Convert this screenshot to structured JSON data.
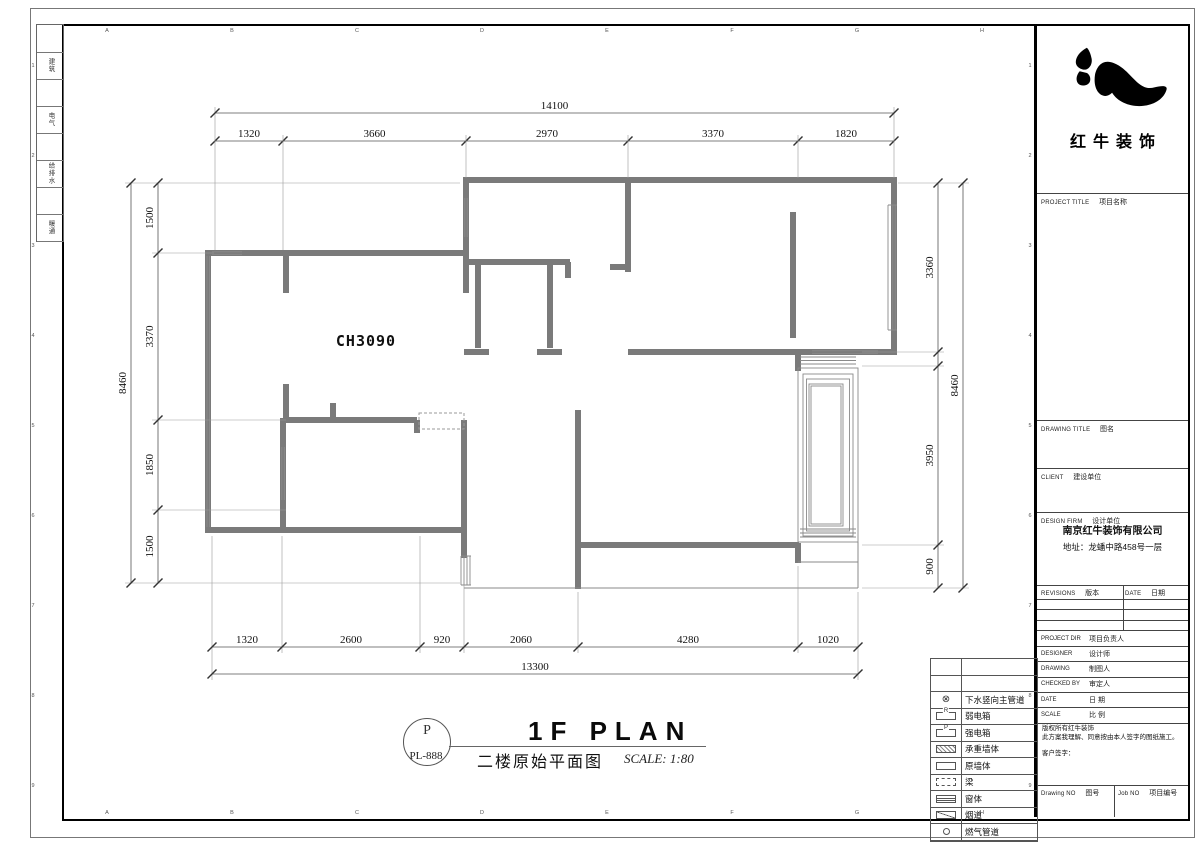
{
  "logo": {
    "company": "红牛装饰"
  },
  "sheet": {
    "disciplines": [
      "建筑",
      "电气",
      "给排水",
      "暖通"
    ],
    "grid_letters": [
      "A",
      "B",
      "C",
      "D",
      "E",
      "F",
      "G",
      "H"
    ],
    "grid_numbers": [
      "1",
      "2",
      "3",
      "4",
      "5",
      "6",
      "7",
      "8",
      "9"
    ]
  },
  "title_block": {
    "project_title": {
      "en": "PROJECT TITLE",
      "cn": "项目名称"
    },
    "drawing_title": {
      "en": "DRAWING TITLE",
      "cn": "图名"
    },
    "client": {
      "en": "CLIENT",
      "cn": "建设单位"
    },
    "design_firm": {
      "en": "DESIGN FIRM",
      "cn": "设计单位"
    },
    "firm_name": "南京红牛装饰有限公司",
    "firm_address": "地址：龙蟠中路458号一层",
    "revisions": {
      "en": "REVISIONS",
      "cn": "版本"
    },
    "date_col": {
      "en": "DATE",
      "cn": "日期"
    },
    "rows": [
      {
        "en": "PROJECT DIR",
        "cn": "项目负责人"
      },
      {
        "en": "DESIGNER",
        "cn": "设计师"
      },
      {
        "en": "DRAWING",
        "cn": "制图人"
      },
      {
        "en": "CHECKED BY",
        "cn": "审定人"
      },
      {
        "en": "DATE",
        "cn": "日 期"
      },
      {
        "en": "SCALE",
        "cn": "比 例"
      }
    ],
    "copyright_lines": [
      "版权所有红牛装饰",
      "此方案我理解、同意按由本人签字的图纸施工。",
      "客户签字："
    ],
    "drawing_no": {
      "en": "Drawing NO",
      "cn": "图号"
    },
    "job_no": {
      "en": "Job NO",
      "cn": "项目编号"
    }
  },
  "legend": {
    "leading_empty_rows": 2,
    "items": [
      {
        "symbol": "drain",
        "label": "下水竖向主管道"
      },
      {
        "symbol": "letter-box",
        "letter": "R",
        "label": "弱电箱"
      },
      {
        "symbol": "letter-box",
        "letter": "P",
        "label": "强电箱"
      },
      {
        "symbol": "hatch-box",
        "label": "承重墙体"
      },
      {
        "symbol": "plain-box",
        "label": "原墙体"
      },
      {
        "symbol": "dashed-box",
        "label": "梁"
      },
      {
        "symbol": "window-box",
        "label": "窗体"
      },
      {
        "symbol": "diag-box",
        "label": "烟道"
      },
      {
        "symbol": "dot",
        "label": "燃气管道"
      }
    ]
  },
  "plan": {
    "room_label": "CH3090"
  },
  "plan_title": {
    "code_letter": "P",
    "code_number": "PL-888",
    "title_en": "1F PLAN",
    "title_cn": "二楼原始平面图",
    "scale": "SCALE: 1:80"
  },
  "dimensions": {
    "top": {
      "overall": {
        "label": "14100",
        "y": 113,
        "from": 215,
        "to": 894
      },
      "inner": {
        "y": 141,
        "ticks": [
          215,
          283,
          466,
          628,
          798,
          894
        ],
        "exts": [
          250,
          250,
          178,
          178,
          178,
          178
        ],
        "labels": [
          "1320",
          "3660",
          "2970",
          "3370",
          "1820"
        ]
      }
    },
    "bottom": {
      "overall": {
        "label": "13300",
        "y": 674,
        "from": 212,
        "to": 858
      },
      "inner": {
        "y": 647,
        "ticks": [
          212,
          282,
          420,
          464,
          578,
          798,
          858
        ],
        "exts": [
          536,
          536,
          536,
          560,
          592,
          566,
          592
        ],
        "labels": [
          "1320",
          "2600",
          "920",
          "2060",
          "4280",
          "1020"
        ]
      }
    },
    "left": {
      "overall": {
        "label": "8460",
        "x": 131,
        "from": 183,
        "to": 583
      },
      "inner": {
        "x": 158,
        "ticks": [
          183,
          253,
          420,
          510,
          583
        ],
        "exts": [
          460,
          214,
          286,
          286,
          460
        ],
        "labels": [
          "1500",
          "3370",
          "1850",
          "1500"
        ]
      }
    },
    "right": {
      "overall": {
        "label": "8460",
        "x": 963,
        "from": 183,
        "to": 588
      },
      "inner": {
        "x": 938,
        "ticks": [
          183,
          352,
          366,
          545,
          588
        ],
        "exts": [
          898,
          862,
          862,
          862,
          862
        ],
        "labels": [
          "3360",
          "",
          "3950",
          "900"
        ]
      }
    }
  }
}
